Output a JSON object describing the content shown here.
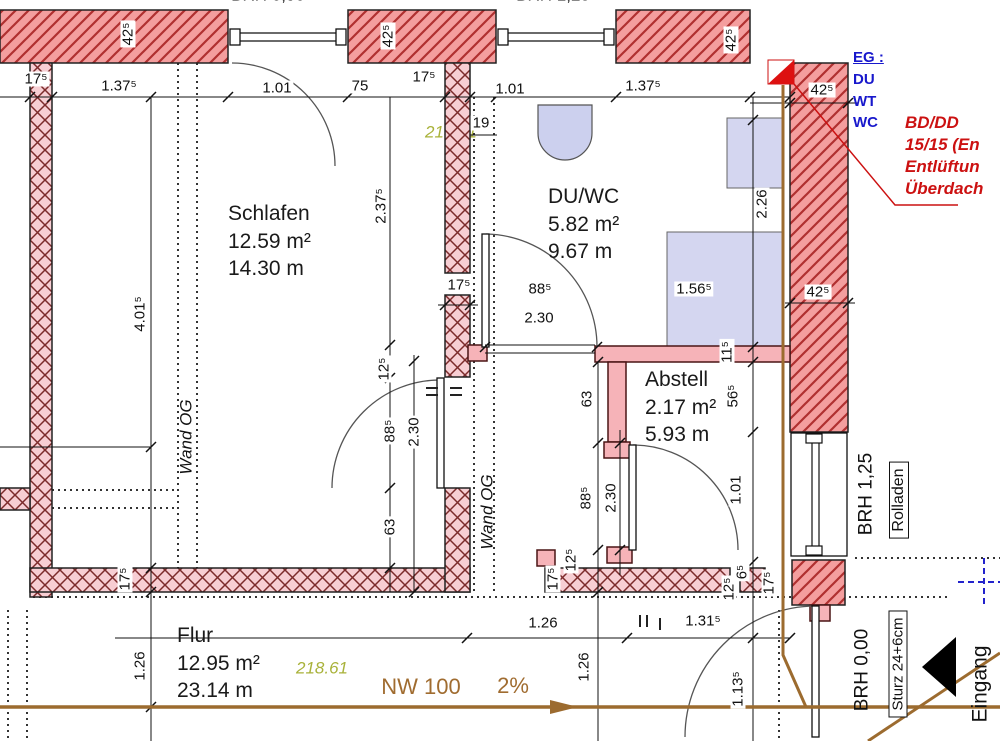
{
  "plan": {
    "title_hint": "floor plan",
    "rooms": [
      {
        "name": "Schlafen",
        "area": "12.59 m²",
        "perimeter": "14.30 m"
      },
      {
        "name": "DU/WC",
        "area": "5.82 m²",
        "perimeter": "9.67 m"
      },
      {
        "name": "Abstell",
        "area": "2.17 m²",
        "perimeter": "5.93 m"
      },
      {
        "name": "Flur",
        "area": "12.95 m²",
        "perimeter": "23.14 m"
      }
    ],
    "annotations": {
      "top_left_brh": "BRH 0,90",
      "top_right_brh": "BRH 1,25",
      "right_brh": "BRH 1,25",
      "rolladen": "Rolladen",
      "bottom_brh": "BRH 0,00",
      "sturz": "Sturz 24+6cm",
      "eingang": "Eingang",
      "wand_og_left": "Wand OG",
      "wand_og_mid": "Wand OG",
      "duct_label_lines": [
        "EG :",
        "DU",
        "WT",
        "WC"
      ],
      "vent_note_lines": [
        "BD/DD",
        "15/15 (En",
        "Entlüftun",
        "Überdach"
      ],
      "pipe_label": "NW 100",
      "pipe_slope": "2%",
      "level_green_hidden": "218.61",
      "level_green": "218.61"
    },
    "dimensions": [
      {
        "t": "17⁵",
        "x": 36,
        "y": 79,
        "r": 0
      },
      {
        "t": "1.37⁵",
        "x": 119,
        "y": 86,
        "r": 0
      },
      {
        "t": "42⁵",
        "x": 128,
        "y": 34,
        "r": -90
      },
      {
        "t": "1.01",
        "x": 277,
        "y": 88,
        "r": 0
      },
      {
        "t": "75",
        "x": 360,
        "y": 86,
        "r": 0
      },
      {
        "t": "17⁵",
        "x": 424,
        "y": 77,
        "r": 0
      },
      {
        "t": "42⁵",
        "x": 388,
        "y": 36,
        "r": -90
      },
      {
        "t": "19",
        "x": 481,
        "y": 123,
        "r": 0
      },
      {
        "t": "1.01",
        "x": 510,
        "y": 89,
        "r": 0
      },
      {
        "t": "1.37⁵",
        "x": 643,
        "y": 86,
        "r": 0
      },
      {
        "t": "42⁵",
        "x": 731,
        "y": 40,
        "r": -90
      },
      {
        "t": "42⁵",
        "x": 822,
        "y": 90,
        "r": 0
      },
      {
        "t": "42⁵",
        "x": 818,
        "y": 292,
        "r": 0
      },
      {
        "t": "2.37⁵",
        "x": 381,
        "y": 206,
        "r": -90
      },
      {
        "t": "2.26",
        "x": 762,
        "y": 204,
        "r": -90
      },
      {
        "t": "1.56⁵",
        "x": 694,
        "y": 289,
        "r": 0
      },
      {
        "t": "17⁵",
        "x": 459,
        "y": 285,
        "r": 0
      },
      {
        "t": "88⁵",
        "x": 540,
        "y": 289,
        "r": 0
      },
      {
        "t": "2.30",
        "x": 539,
        "y": 318,
        "r": 0
      },
      {
        "t": "11⁵",
        "x": 727,
        "y": 352,
        "r": -90
      },
      {
        "t": "12⁵",
        "x": 384,
        "y": 369,
        "r": -90
      },
      {
        "t": "88⁵",
        "x": 390,
        "y": 431,
        "r": -90
      },
      {
        "t": "2.30",
        "x": 414,
        "y": 432,
        "r": -90
      },
      {
        "t": "63",
        "x": 390,
        "y": 527,
        "r": -90
      },
      {
        "t": "56⁵",
        "x": 733,
        "y": 396,
        "r": -90
      },
      {
        "t": "63",
        "x": 587,
        "y": 399,
        "r": -90
      },
      {
        "t": "1.01",
        "x": 736,
        "y": 490,
        "r": -90
      },
      {
        "t": "88⁵",
        "x": 586,
        "y": 498,
        "r": -90
      },
      {
        "t": "2.30",
        "x": 611,
        "y": 498,
        "r": -90
      },
      {
        "t": "4.01⁵",
        "x": 140,
        "y": 314,
        "r": -90
      },
      {
        "t": "17⁵",
        "x": 125,
        "y": 579,
        "r": -90
      },
      {
        "t": "12⁵",
        "x": 571,
        "y": 560,
        "r": -90
      },
      {
        "t": "17⁵",
        "x": 553,
        "y": 579,
        "r": -90
      },
      {
        "t": "12⁵",
        "x": 729,
        "y": 589,
        "r": -90
      },
      {
        "t": "6⁵",
        "x": 742,
        "y": 572,
        "r": -90
      },
      {
        "t": "17⁵",
        "x": 769,
        "y": 583,
        "r": -90
      },
      {
        "t": "1.26",
        "x": 543,
        "y": 623,
        "r": 0
      },
      {
        "t": "1.31⁵",
        "x": 703,
        "y": 621,
        "r": 0
      },
      {
        "t": "1.26",
        "x": 140,
        "y": 666,
        "r": -90
      },
      {
        "t": "1.26",
        "x": 584,
        "y": 667,
        "r": -90
      },
      {
        "t": "1.13⁵",
        "x": 738,
        "y": 689,
        "r": -90
      }
    ],
    "colors": {
      "wall_hatch_bg": "#f49e9e",
      "wall_hatch_line": "#b03030",
      "wall_cross_bg": "#f7ced3",
      "wall_cross_line": "#7c2b2b",
      "partition_pink": "#f6b3b8",
      "fixture_lavender": "#d4d6f0",
      "pipe_brown": "#9c6b2f",
      "note_red": "#cc1111",
      "note_blue": "#1818cc",
      "level_green": "#a9b23a",
      "pipe_text_brown": "#a06c30"
    }
  }
}
